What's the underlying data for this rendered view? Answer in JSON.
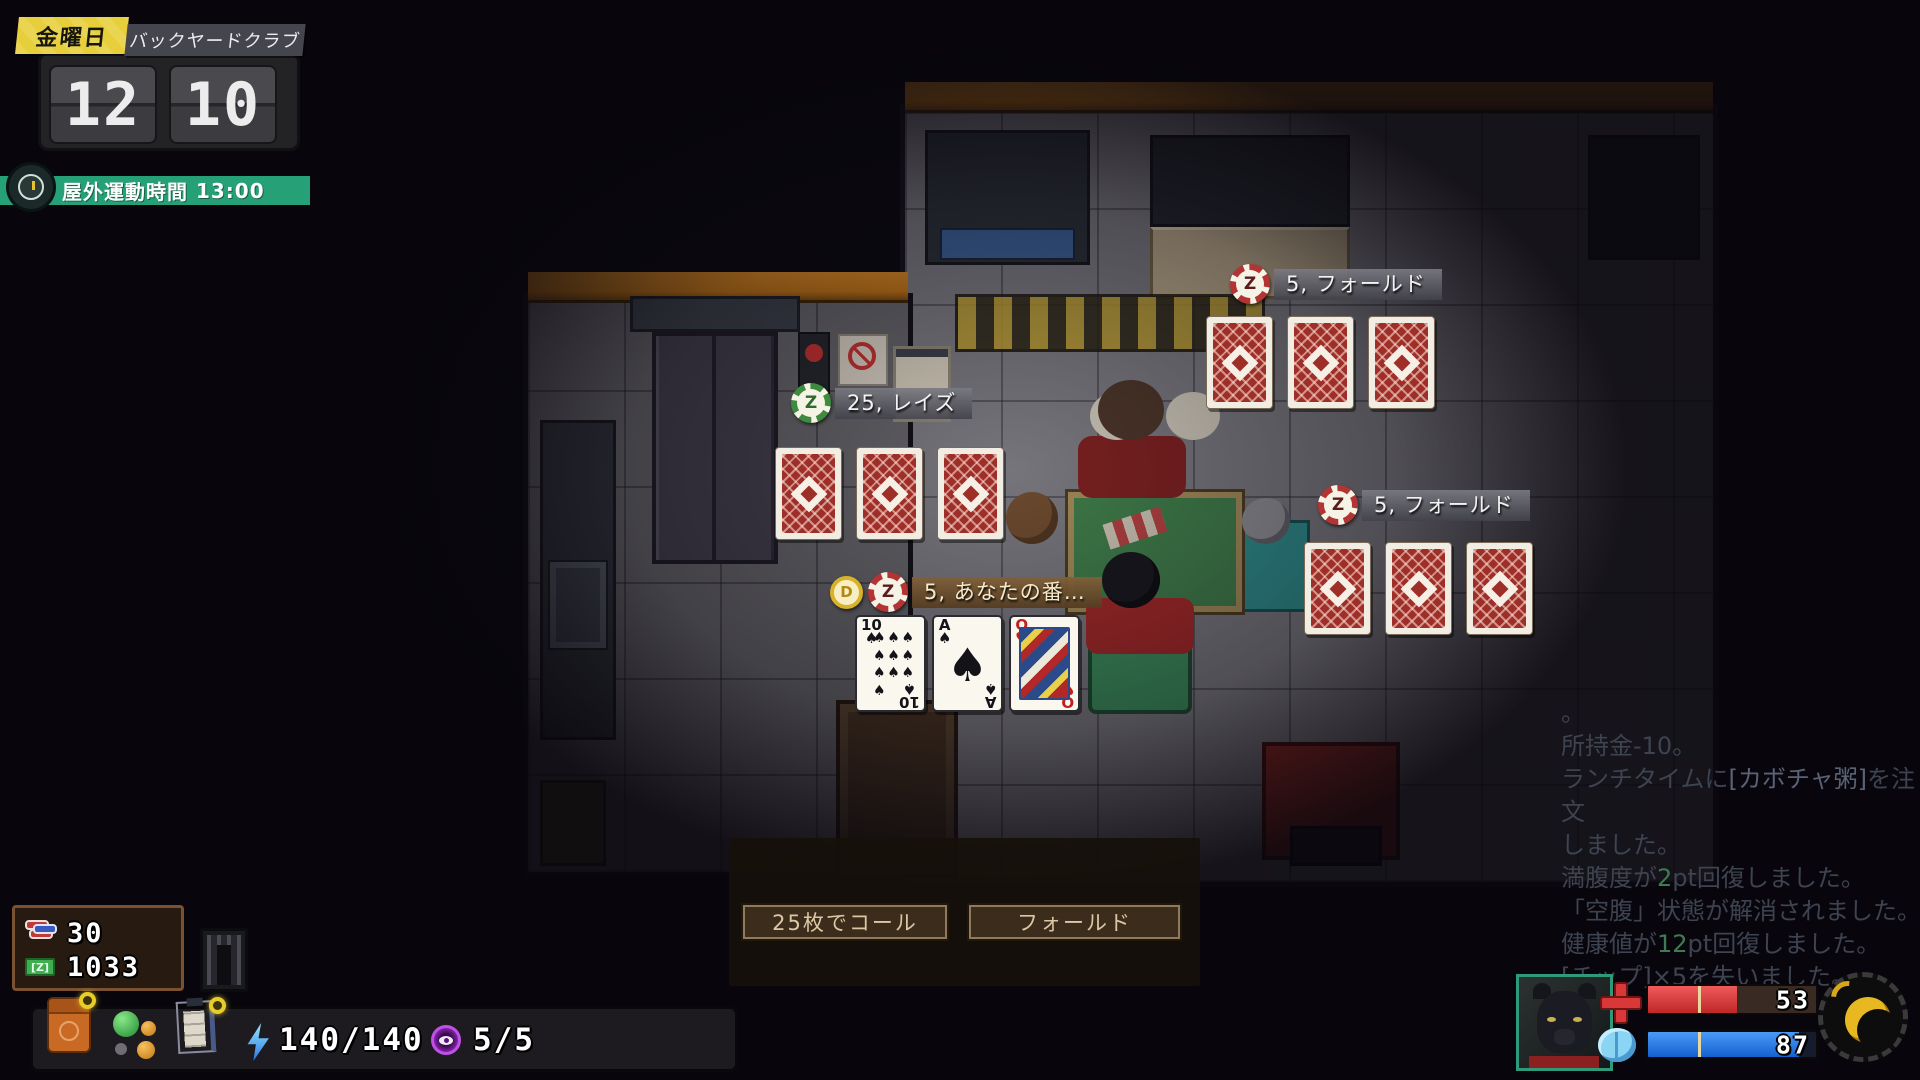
{
  "hud": {
    "day": "金曜日",
    "location": "バックヤードクラブ",
    "clock": {
      "hour": "12",
      "minute": "10"
    },
    "schedule_label": "屋外運動時間",
    "schedule_time": "13:00"
  },
  "poker": {
    "chip_letter": "Z",
    "dealer_letter": "D",
    "raise_text": "25, レイズ",
    "fold_top_text": "5, フォールド",
    "fold_right_text": "5, フォールド",
    "turn_text": "5, あなたの番…",
    "hand": [
      {
        "rank": "10",
        "suit": "♠",
        "color": "black"
      },
      {
        "rank": "A",
        "suit": "♠",
        "color": "black"
      },
      {
        "rank": "Q",
        "suit": "♥",
        "color": "red"
      }
    ]
  },
  "dialog": {
    "call_label": "25枚でコール",
    "fold_label": "フォールド"
  },
  "wallet": {
    "chips": "30",
    "cash": "1033"
  },
  "status_bar": {
    "energy": "140/140",
    "actions": "5/5"
  },
  "vitals": {
    "health": "53",
    "mind": "87",
    "health_pct": 53,
    "mind_pct": 90,
    "tick_pct": 30
  },
  "colors": {
    "chip_green": "#3e8a3e",
    "chip_red": "#b43434",
    "dealer_gold": "#d8b22a",
    "health_fill": "#e03c3c",
    "mind_fill": "#1e7ae8",
    "schedule_green": "#26a077",
    "day_yellow": "#e6cf3a"
  },
  "log": {
    "lines": [
      [
        {
          "t": "。"
        }
      ],
      [
        {
          "t": "所持金-10。"
        }
      ],
      [
        {
          "t": "ランチタイムに"
        },
        {
          "t": "[カボチャ粥]",
          "c": "hl"
        },
        {
          "t": "を注文"
        }
      ],
      [
        {
          "t": "しました。"
        }
      ],
      [
        {
          "t": "満腹度が"
        },
        {
          "t": "2",
          "c": "green"
        },
        {
          "t": "pt回復しました。"
        }
      ],
      [
        {
          "t": "「空腹」状態が解消されました。"
        }
      ],
      [
        {
          "t": "健康値が"
        },
        {
          "t": "12",
          "c": "green"
        },
        {
          "t": "pt回復しました。"
        }
      ],
      [
        {
          "t": "[チップ]×5を失いました。"
        }
      ]
    ]
  }
}
